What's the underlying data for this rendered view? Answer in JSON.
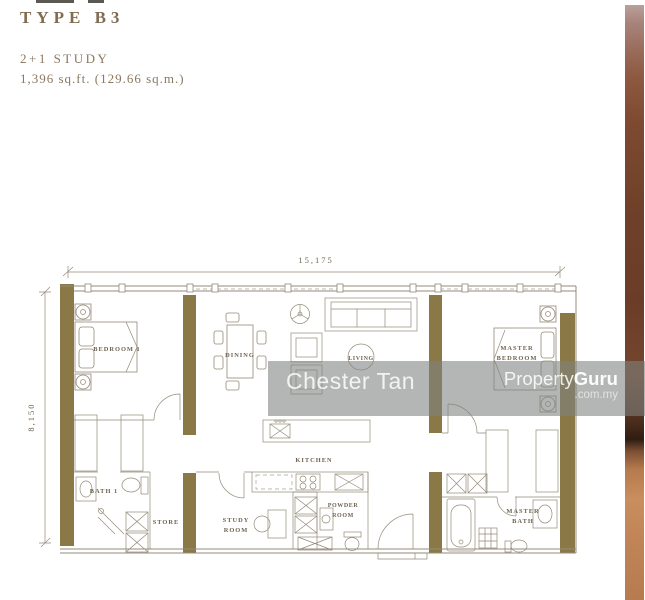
{
  "header": {
    "type_label": "TYPE B3",
    "config_label": "2+1 STUDY",
    "area_label": "1,396 sq.ft.  (129.66 sq.m.)"
  },
  "dimensions": {
    "width": "15,175",
    "height": "8,150"
  },
  "rooms": {
    "bedroom1": "BEDROOM 1",
    "dining": "DINING",
    "living": "LIVING",
    "master_bedroom_l1": "MASTER",
    "master_bedroom_l2": "BEDROOM",
    "kitchen": "KITCHEN",
    "bath1": "BATH 1",
    "store": "STORE",
    "study_l1": "STUDY",
    "study_l2": "ROOM",
    "powder_l1": "POWDER",
    "powder_l2": "ROOM",
    "master_bath_l1": "MASTER",
    "master_bath_l2": "BATH"
  },
  "watermarks": {
    "agent": "Chester Tan",
    "brand_left": "Property",
    "brand_right": "Guru",
    "brand_domain": ".com.my"
  },
  "colors": {
    "wall": "#8a7946",
    "line": "#938a78",
    "label": "#6f6352",
    "title": "#7f6c51",
    "subtitle": "#8a7962",
    "watermark_band": "rgba(125,129,127,0.58)"
  }
}
